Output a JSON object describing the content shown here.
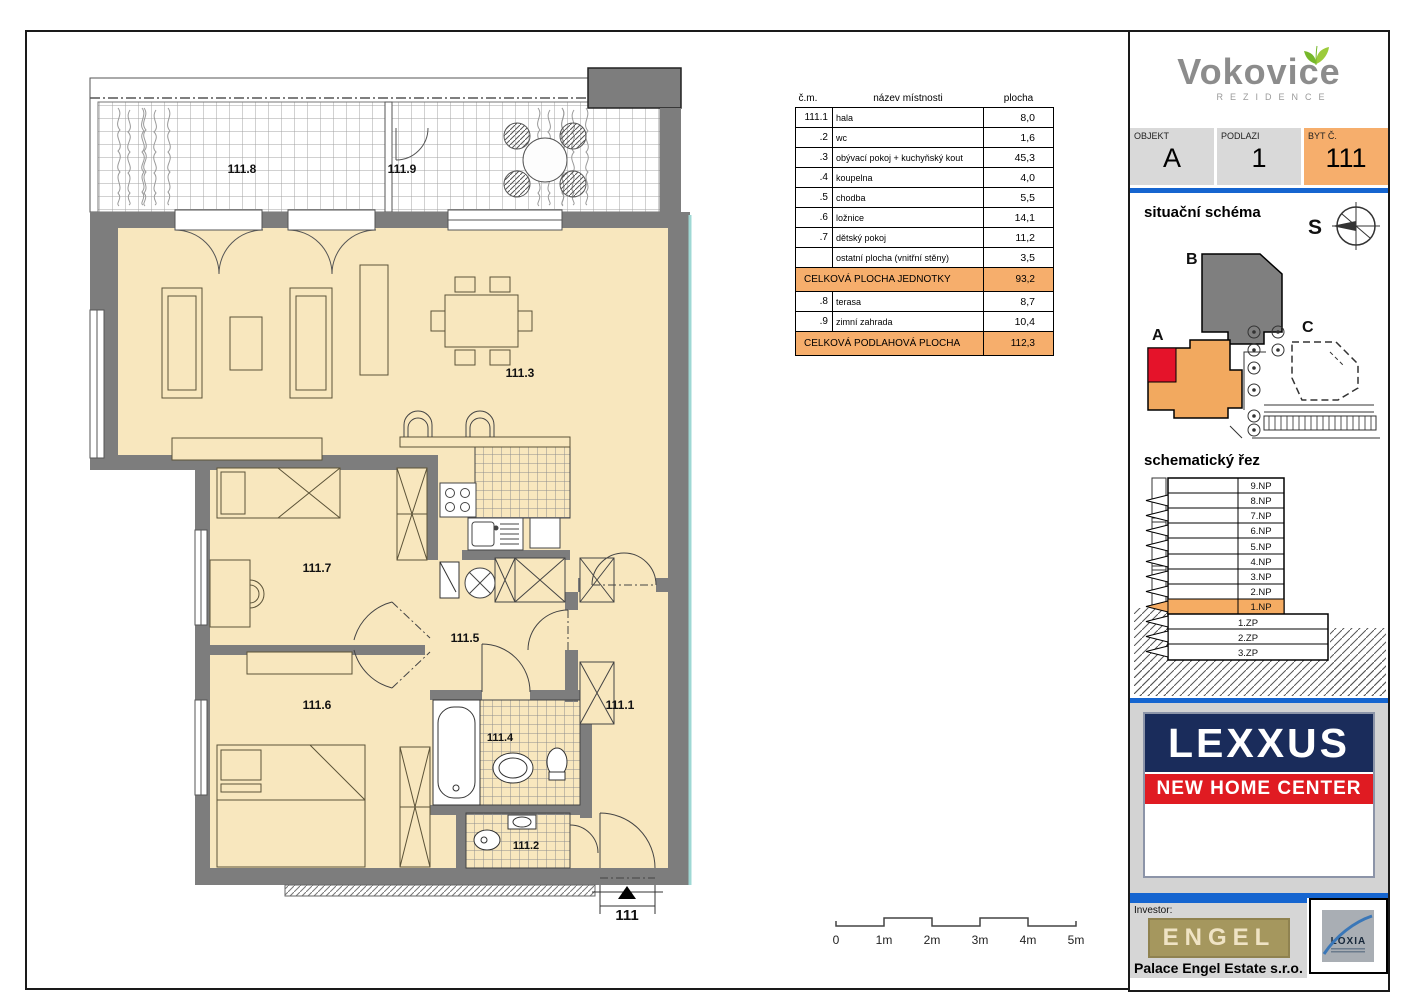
{
  "plan": {
    "labels": {
      "hala": "111.1",
      "wc": "111.2",
      "living": "111.3",
      "koupelna": "111.4",
      "chodba": "111.5",
      "loznice": "111.6",
      "detsky": "111.7",
      "terasa": "111.8",
      "zimni": "111.9",
      "entry": "111"
    }
  },
  "room_table": {
    "col_num": "č.m.",
    "col_name": "název místnosti",
    "col_area": "plocha",
    "rows": [
      {
        "num": "111.1",
        "name": "hala",
        "area": "8,0"
      },
      {
        "num": ".2",
        "name": "wc",
        "area": "1,6"
      },
      {
        "num": ".3",
        "name": "obývací pokoj + kuchyňský kout",
        "area": "45,3"
      },
      {
        "num": ".4",
        "name": "koupelna",
        "area": "4,0"
      },
      {
        "num": ".5",
        "name": "chodba",
        "area": "5,5"
      },
      {
        "num": ".6",
        "name": "ložnice",
        "area": "14,1"
      },
      {
        "num": ".7",
        "name": "dětský pokoj",
        "area": "11,2"
      },
      {
        "num": "",
        "name": "ostatní plocha (vnitřní stěny)",
        "area": "3,5"
      }
    ],
    "total_unit_label": "CELKOVÁ PLOCHA JEDNOTKY",
    "total_unit_area": "93,2",
    "rows_outdoor": [
      {
        "num": ".8",
        "name": "terasa",
        "area": "8,7"
      },
      {
        "num": ".9",
        "name": "zimní zahrada",
        "area": "10,4"
      }
    ],
    "total_floor_label": "CELKOVÁ PODLAHOVÁ PLOCHA",
    "total_floor_area": "112,3"
  },
  "scalebar": {
    "l0": "0",
    "l1": "1m",
    "l2": "2m",
    "l3": "3m",
    "l4": "4m",
    "l5": "5m"
  },
  "sidebar": {
    "brand": "Vokovice",
    "brand_sub": "REZIDENCE",
    "objekt_label": "OBJEKT",
    "objekt_value": "A",
    "podlazi_label": "PODLAZI",
    "podlazi_value": "1",
    "byt_label": "BYT Č.",
    "byt_value": "111",
    "situ_title": "situační schéma",
    "north": "S",
    "bldg_a": "A",
    "bldg_b": "B",
    "bldg_c": "C",
    "rez_title": "schematický řez",
    "floors": [
      "9.NP",
      "8.NP",
      "7.NP",
      "6.NP",
      "5.NP",
      "4.NP",
      "3.NP",
      "2.NP",
      "1.NP"
    ],
    "basements": [
      "1.ZP",
      "2.ZP",
      "3.ZP"
    ],
    "highlighted_floor": "1.NP",
    "lexxus": "LEXXUS",
    "lexxus_sub": "NEW HOME CENTER",
    "investor_label": "Investor:",
    "investor_logo": "ENGEL",
    "investor_company": "Palace Engel Estate s.r.o.",
    "architect": "LOXIA"
  },
  "colors": {
    "accent_orange": "#F6AE6C",
    "unit_red": "#E5132A",
    "wall_gray": "#7D7D7D",
    "floor_cream": "#F8E7BE",
    "blue_line": "#1565D0",
    "lexxus_navy": "#1A2C5B",
    "lexxus_red": "#E01B22"
  }
}
